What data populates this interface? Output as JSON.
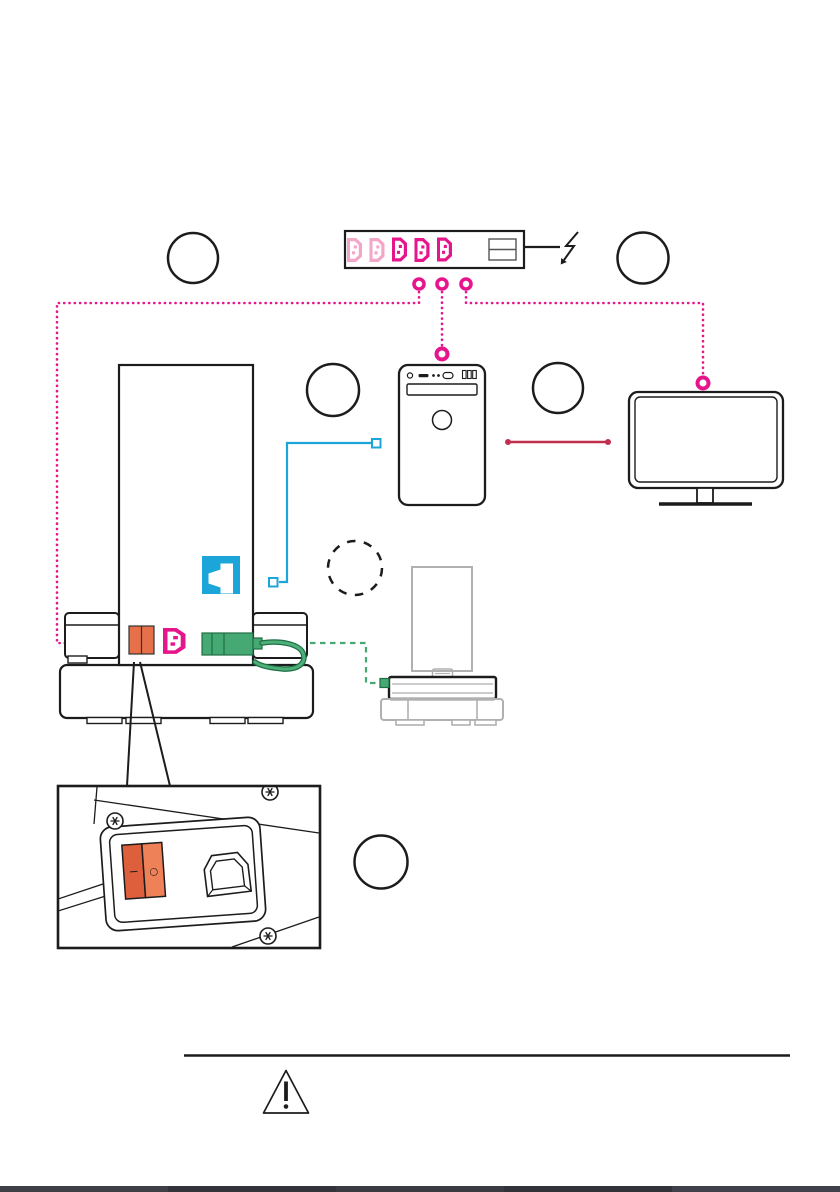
{
  "colors": {
    "magenta": "#e7158c",
    "pink": "#f4a6c9",
    "cyan": "#1ca5d8",
    "red": "#c22f4e",
    "green": "#46a873",
    "green_dark": "#1e6f46",
    "orange": "#e5704a",
    "orange_light": "#ee8158",
    "orange_dark": "#de5f3b",
    "ink": "#1c1c1c",
    "gray": "#b0b0b0"
  },
  "power_strip": {
    "outlets": [
      "pink",
      "pink",
      "magenta",
      "magenta",
      "magenta"
    ],
    "switch_cells": 2
  },
  "callouts": {
    "count": 6,
    "labels": [
      "",
      "",
      "",
      "",
      "",
      ""
    ],
    "styles": [
      "solid",
      "solid",
      "solid",
      "solid",
      "dashed",
      "solid"
    ]
  },
  "connections": [
    {
      "name": "power-cords",
      "color_key": "magenta",
      "style": "dotted",
      "endpoints": [
        "power-strip",
        "main-machine",
        "computer",
        "monitor"
      ]
    },
    {
      "name": "data-cable",
      "color_key": "cyan",
      "style": "solid",
      "endpoints": [
        "main-machine",
        "computer"
      ]
    },
    {
      "name": "video-cable",
      "color_key": "red",
      "style": "solid",
      "endpoints": [
        "computer",
        "monitor"
      ]
    },
    {
      "name": "accessory-cable",
      "color_key": "green",
      "style": "dashed",
      "endpoints": [
        "main-machine",
        "dock-device"
      ]
    }
  ],
  "inset": {
    "rocker_switch": {
      "on_symbol": "−",
      "off_symbol": "○"
    }
  },
  "footer": {
    "segments": [
      "#3e3e47",
      "#33333c",
      "#3a3a43",
      "#32323b",
      "#40404a"
    ]
  }
}
